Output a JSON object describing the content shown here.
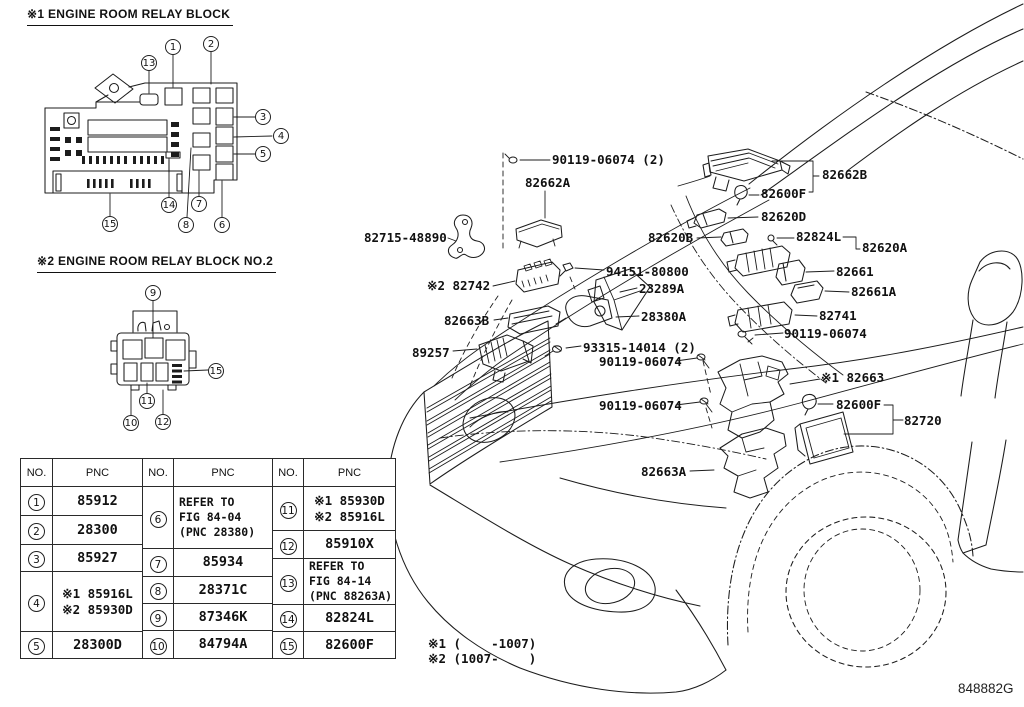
{
  "figure": {
    "code": "848882G"
  },
  "titles": {
    "block1": "※1 ENGINE ROOM RELAY BLOCK",
    "block2": "※2 ENGINE ROOM RELAY BLOCK NO.2"
  },
  "notes": {
    "n1": "※1 (    -1007)",
    "n2": "※2 (1007-    )"
  },
  "callouts": {
    "block1": [
      "13",
      "1",
      "2",
      "3",
      "4",
      "5",
      "15",
      "14",
      "7",
      "8",
      "6"
    ],
    "block2": [
      "9",
      "15",
      "10",
      "11",
      "12"
    ]
  },
  "table": {
    "headers": [
      "NO.",
      "PNC",
      "NO.",
      "PNC",
      "NO.",
      "PNC"
    ],
    "groupA": [
      {
        "no": "1",
        "pnc": "85912"
      },
      {
        "no": "2",
        "pnc": "28300"
      },
      {
        "no": "3",
        "pnc": "85927"
      },
      {
        "no": "4",
        "pnc": "※1 85916L\n※2 85930D"
      },
      {
        "no": "5",
        "pnc": "28300D"
      }
    ],
    "groupB": [
      {
        "no": "6",
        "pnc": "REFER TO\nFIG 84-04\n(PNC 28380)"
      },
      {
        "no": "7",
        "pnc": "85934"
      },
      {
        "no": "8",
        "pnc": "28371C"
      },
      {
        "no": "9",
        "pnc": "87346K"
      },
      {
        "no": "10",
        "pnc": "84794A"
      }
    ],
    "groupC": [
      {
        "no": "11",
        "pnc": "※1 85930D\n※2 85916L"
      },
      {
        "no": "12",
        "pnc": "85910X"
      },
      {
        "no": "13",
        "pnc": "REFER TO\nFIG 84-14\n(PNC 88263A)"
      },
      {
        "no": "14",
        "pnc": "82824L"
      },
      {
        "no": "15",
        "pnc": "82600F"
      }
    ]
  },
  "labels": {
    "l90119_top": "90119-06074 (2)",
    "l82662A": "82662A",
    "l82715": "82715-48890",
    "l82662B": "82662B",
    "l82600F_top": "82600F",
    "l82620D": "82620D",
    "l82620B": "82620B",
    "l82824L": "82824L",
    "l82620A": "82620A",
    "l82661": "82661",
    "l82661A": "82661A",
    "l82741": "82741",
    "l90119_right": "90119-06074",
    "l82742": "※2 82742",
    "l94151": "94151-80800",
    "l23289A": "23289A",
    "l28380A": "28380A",
    "l82663B": "82663B",
    "l89257": "89257",
    "l93315": "93315-14014 (2)",
    "l90119_mid1": "90119-06074",
    "l90119_mid2": "90119-06074",
    "l82663A": "82663A",
    "l82663": "※1 82663",
    "l82600F_low": "82600F",
    "l82720": "82720"
  }
}
